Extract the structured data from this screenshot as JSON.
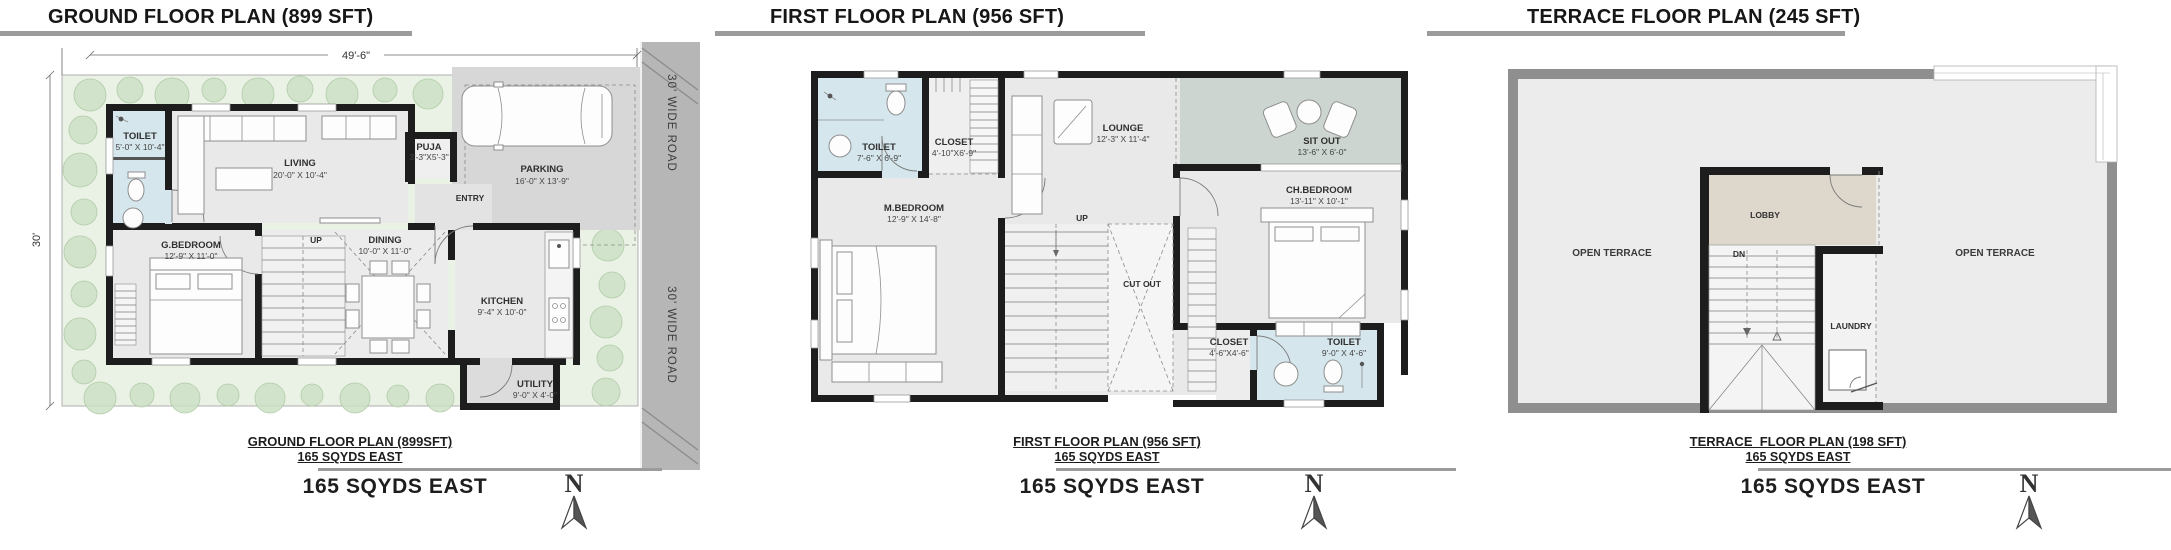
{
  "colors": {
    "wall": "#1d1d1d",
    "wet": "#d5e7ed",
    "sitout": "#ccd5cf",
    "lobby": "#ded8cc",
    "plot": "#eaf1e5",
    "tree": "#cde1c6",
    "road": "#b6b6b6",
    "pad": "#d7d7d7",
    "bar": "#9b9b9b",
    "ring": "#8f8f8f"
  },
  "panes": [
    {
      "title": "GROUND FLOOR PLAN (899 SFT)",
      "dims": {
        "width_label": "49'-6\"",
        "height_label": "30'"
      },
      "road_label_top": "30' WIDE ROAD",
      "road_label_bottom": "30' WIDE ROAD",
      "rooms": {
        "toilet": {
          "name": "TOILET",
          "size": "5'-0\" X 10'-4\""
        },
        "living": {
          "name": "LIVING",
          "size": "20'-0\" X 10'-4\""
        },
        "puja": {
          "name": "PUJA",
          "size": "3'-3\"X5'-3\""
        },
        "parking": {
          "name": "PARKING",
          "size": "16'-0\" X 13'-9\""
        },
        "entry": {
          "name": "ENTRY"
        },
        "gbedroom": {
          "name": "G.BEDROOM",
          "size": "12'-9\" X 11'-0\""
        },
        "dining": {
          "name": "DINING",
          "size": "10'-0\" X 11'-0\""
        },
        "kitchen": {
          "name": "KITCHEN",
          "size": "9'-4\" X 10'-0\""
        },
        "utility": {
          "name": "UTILITY",
          "size": "9'-0\" X 4'-0\""
        },
        "up": {
          "name": "UP"
        }
      },
      "captions": {
        "line1": "GROUND FLOOR PLAN (899SFT)",
        "line2": "165 SQYDS EAST",
        "bold": "165 SQYDS EAST"
      },
      "north_label": "N"
    },
    {
      "title": "FIRST FLOOR PLAN (956 SFT)",
      "rooms": {
        "toilet": {
          "name": "TOILET",
          "size": "7'-6\" X 6'-9\""
        },
        "closet": {
          "name": "CLOSET",
          "size": "4'-10\"X6'-9\""
        },
        "lounge": {
          "name": "LOUNGE",
          "size": "12'-3\" X 11'-4\""
        },
        "sitout": {
          "name": "SIT OUT",
          "size": "13'-6\" X 6'-0\""
        },
        "mbedroom": {
          "name": "M.BEDROOM",
          "size": "12'-9\" X 14'-8\""
        },
        "chbedroom": {
          "name": "CH.BEDROOM",
          "size": "13'-11\" X 10'-1\""
        },
        "cutout": {
          "name": "CUT OUT"
        },
        "closet2": {
          "name": "CLOSET",
          "size": "4'-6\"X4'-6\""
        },
        "toilet2": {
          "name": "TOILET",
          "size": "9'-0\" X 4'-6\""
        },
        "up": {
          "name": "UP"
        }
      },
      "captions": {
        "line1": "FIRST FLOOR PLAN (956 SFT)",
        "line2": "165 SQYDS EAST",
        "bold": "165 SQYDS EAST"
      },
      "north_label": "N"
    },
    {
      "title": "TERRACE FLOOR PLAN (245 SFT)",
      "rooms": {
        "open_left": {
          "name": "OPEN TERRACE"
        },
        "open_right": {
          "name": "OPEN TERRACE"
        },
        "lobby": {
          "name": "LOBBY"
        },
        "dn": {
          "name": "DN"
        },
        "laundry": {
          "name": "LAUNDRY"
        }
      },
      "captions": {
        "line1": "TERRACE  FLOOR PLAN (198 SFT)",
        "line2": "165 SQYDS EAST",
        "bold": "165 SQYDS EAST"
      },
      "north_label": "N"
    }
  ]
}
